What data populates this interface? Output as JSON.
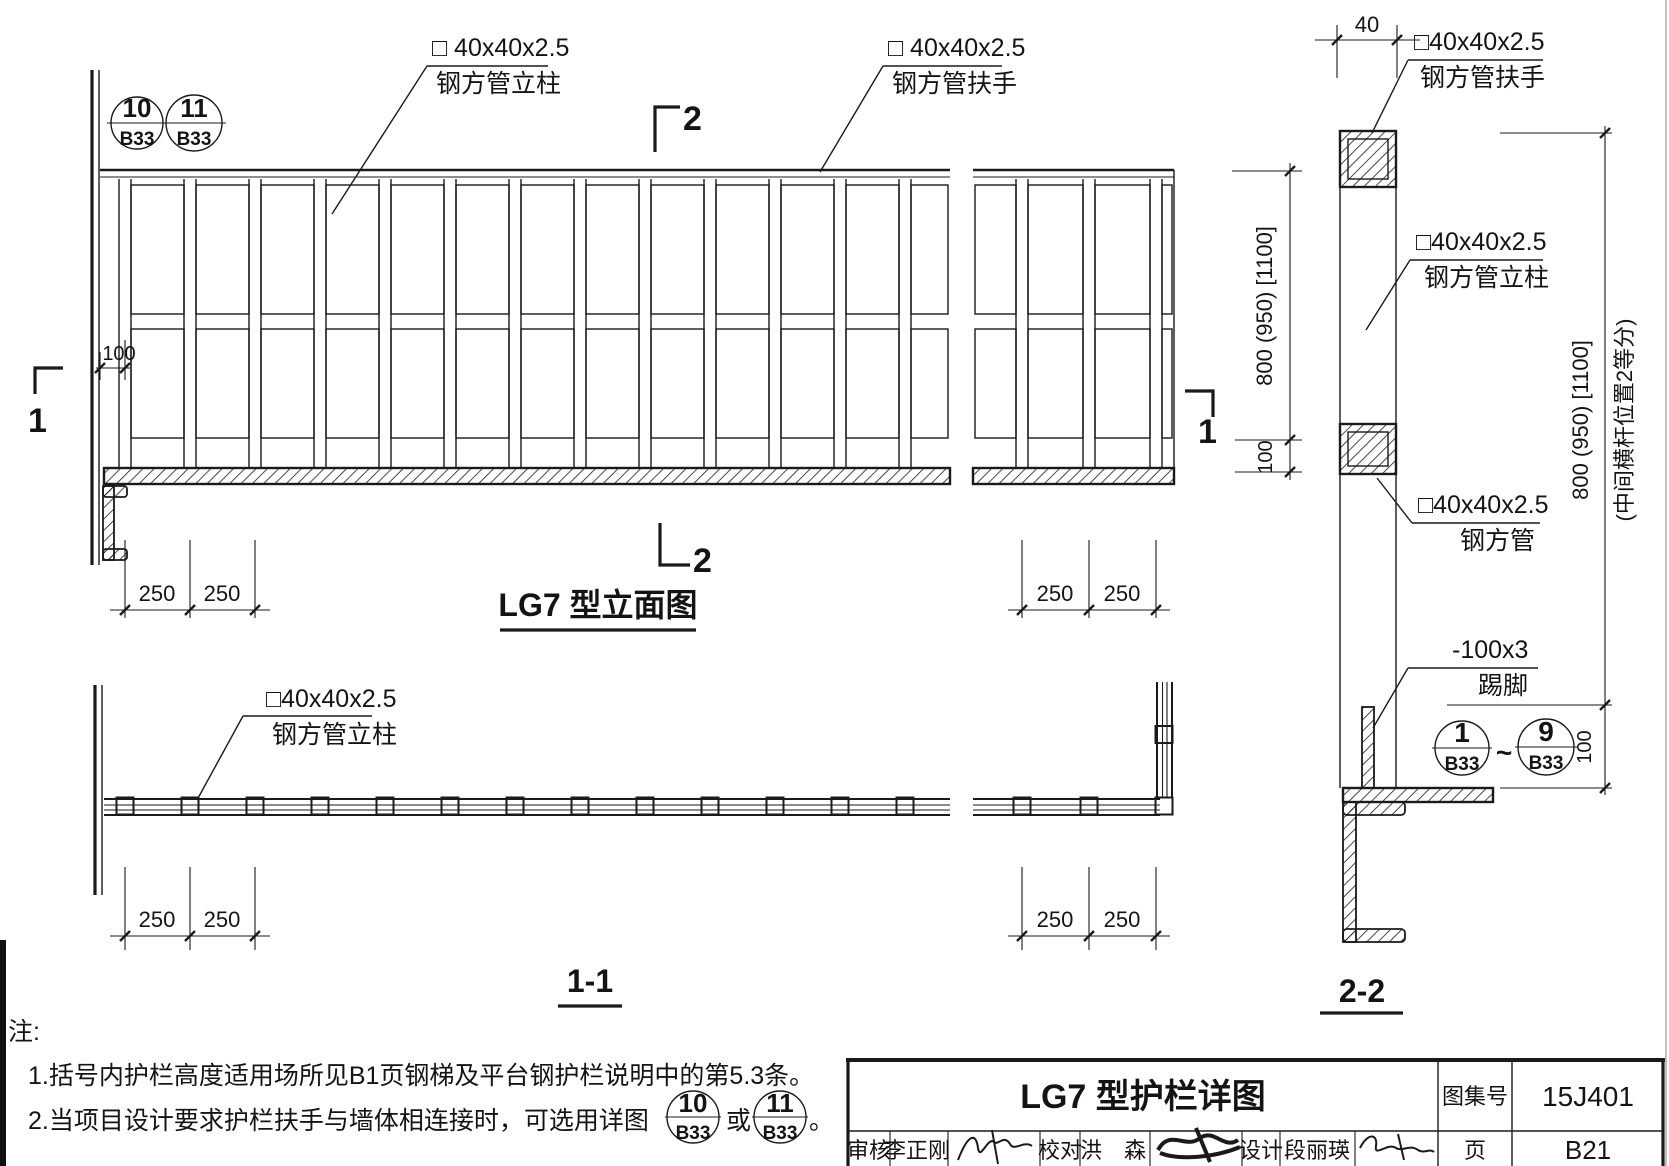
{
  "colors": {
    "ink": "#1a1a1a",
    "paper": "#ffffff"
  },
  "elevation": {
    "title": "LG7 型立面图",
    "bubble_a_num": "10",
    "bubble_a_page": "B33",
    "bubble_b_num": "11",
    "bubble_b_page": "B33",
    "post_label1": "□ 40x40x2.5",
    "post_label2": "钢方管立柱",
    "rail_label1": "□ 40x40x2.5",
    "rail_label2": "钢方管扶手",
    "marker_top": "2",
    "marker_bottom": "2",
    "marker_left": "1",
    "marker_right": "1",
    "dim_wall": "100",
    "dim_left": [
      "250",
      "250"
    ],
    "dim_right": [
      "250",
      "250"
    ],
    "dim_height": "800 (950) [1100]",
    "dim_kick": "100"
  },
  "plan": {
    "title": "1-1",
    "post_label1": "□40x40x2.5",
    "post_label2": "钢方管立柱",
    "dim_left": [
      "250",
      "250"
    ],
    "dim_right": [
      "250",
      "250"
    ]
  },
  "section": {
    "title": "2-2",
    "dim_top": "40",
    "rail_label1": "□40x40x2.5",
    "rail_label2": "钢方管扶手",
    "post_label1": "□40x40x2.5",
    "post_label2": "钢方管立柱",
    "mid_label1": "□40x40x2.5",
    "mid_label2": "钢方管",
    "kick_label1": "-100x3",
    "kick_label2": "踢脚",
    "dim_height": "800 (950) [1100]",
    "dim_note": "(中间横杆位置2等分)",
    "dim_kick": "100",
    "bubble_from_num": "1",
    "bubble_from_page": "B33",
    "tilde": "~",
    "bubble_to_num": "9",
    "bubble_to_page": "B33"
  },
  "notes": {
    "header": "注:",
    "line1": "1.括号内护栏高度适用场所见B1页钢梯及平台钢护栏说明中的第5.3条。",
    "line2": "2.当项目设计要求护栏扶手与墙体相连接时，可选用详图",
    "or": "或",
    "period": "。",
    "bubble_a_num": "10",
    "bubble_a_page": "B33",
    "bubble_b_num": "11",
    "bubble_b_page": "B33"
  },
  "titleblock": {
    "title": "LG7 型护栏详图",
    "atlas_label": "图集号",
    "atlas_no": "15J401",
    "page_label": "页",
    "page_no": "B21",
    "reviewer_label": "审核",
    "reviewer": "李正刚",
    "checker_label": "校对",
    "checker": "洪　森",
    "designer_label": "设计",
    "designer": "段丽瑛"
  }
}
